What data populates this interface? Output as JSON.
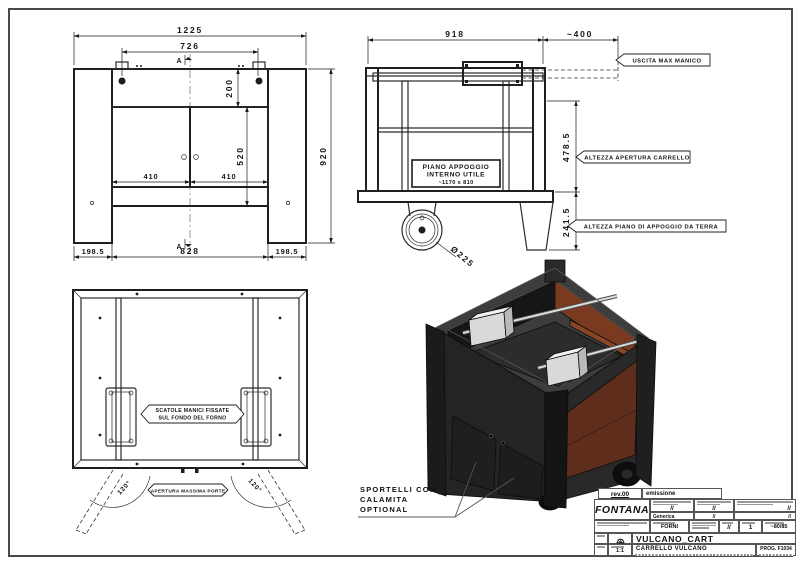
{
  "front_view": {
    "dim_1225": "1225",
    "dim_726": "726",
    "dim_200": "200",
    "dim_520": "520",
    "dim_920": "920",
    "dim_410_left": "410",
    "dim_410_right": "410",
    "dim_198_left": "198.5",
    "dim_828": "828",
    "dim_198_right": "198.5",
    "section_top": "A",
    "section_bottom": "A"
  },
  "side_view": {
    "dim_918": "918",
    "dim_400": "~400",
    "dim_478": "478.5",
    "dim_241": "241.5",
    "dim_wheel": "Ø225",
    "flag_uscita": "USCITA MAX MANICO",
    "flag_apertura": "ALTEZZA APERTURA CARRELLO",
    "flag_terra": "ALTEZZA PIANO DI APPOGGIO DA TERRA",
    "piano_box": [
      "PIANO APPOGGIO",
      "INTERNO UTILE",
      "~1170 x 810"
    ]
  },
  "top_view": {
    "callout_scatole": [
      "SCATOLE MANICI FISSATE",
      "SUL FONDO DEL FORNO"
    ],
    "callout_apertura": "APERTURA MASSIMA PORTE",
    "angle_left": "120°",
    "angle_right": "120°"
  },
  "iso_view": {
    "callout": [
      "SPORTELLI CON",
      "CALAMITA",
      "OPTIONAL"
    ]
  },
  "title_block": {
    "rev": "rev.00",
    "rev_desc": "emissione",
    "brand": "FONTANA",
    "val1": "//",
    "val2": "//",
    "val3": "//",
    "family_label": "Generica",
    "family_val": "//",
    "gen_val2": "//",
    "dept": "FORNI",
    "val4": "//",
    "qty": "1",
    "weight": "~80/85",
    "code": "VULCANO_CART",
    "scale": "1:1",
    "title": "CARRELLO VULCANO",
    "prog": "PROG. F1034"
  },
  "colors": {
    "line": "#2b2b2b",
    "body_dark": "#262626",
    "interior_rust": "#7a3a20",
    "metal": "#d9d9d9"
  }
}
